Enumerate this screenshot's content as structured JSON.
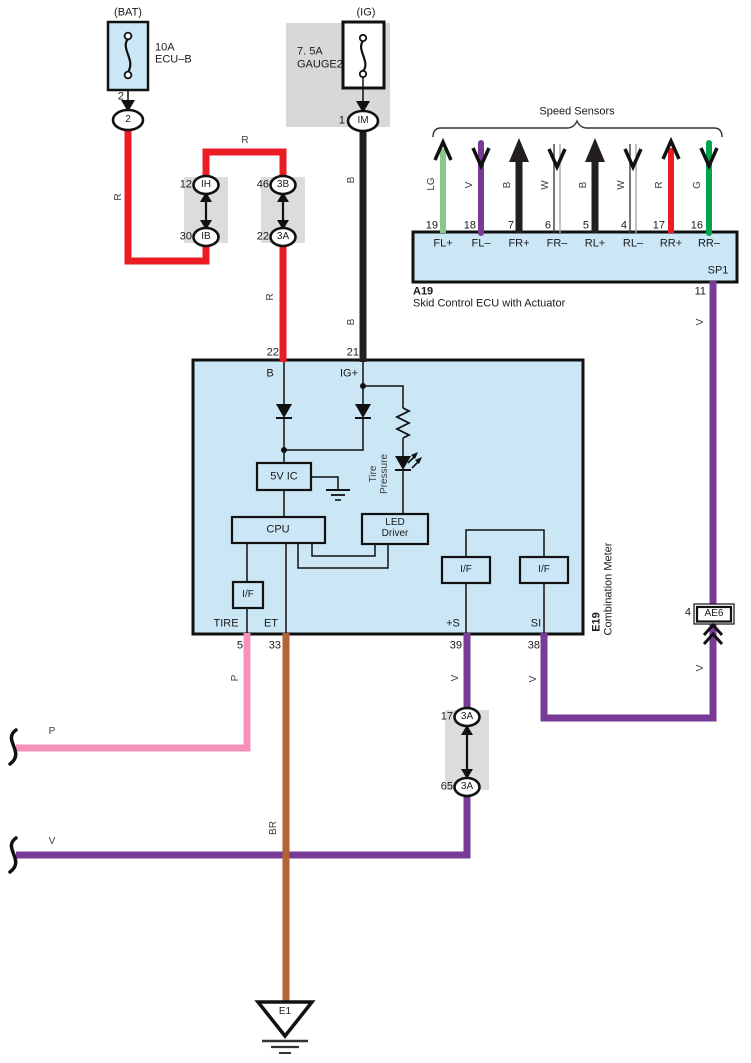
{
  "colors": {
    "box_fill": "#cbe7f6",
    "panel_gray": "#d8d8d8",
    "wire_red": "#ec1c24",
    "wire_black": "#231f20",
    "wire_purple": "#7a3b96",
    "wire_pink": "#f490ba",
    "wire_brown": "#b26235",
    "wire_green": "#00a550",
    "wire_light_green": "#85c98e"
  },
  "bat_circuit": {
    "header": "(BAT)",
    "fuse_rating": "10A",
    "fuse_name": "ECU–B",
    "pin": "2",
    "connector": "2"
  },
  "ig_circuit": {
    "header": "(IG)",
    "fuse_rating": "7. 5A",
    "fuse_name": "GAUGE2",
    "pin": "1",
    "connector": "IM"
  },
  "wires": {
    "r": "R",
    "b": "B",
    "v": "V",
    "p": "P",
    "br": "BR"
  },
  "junction_ih": {
    "top_pin": "12",
    "top_label": "IH",
    "bottom_pin": "30",
    "bottom_label": "IB"
  },
  "junction_3b": {
    "top_pin": "46",
    "top_label": "3B",
    "bottom_pin": "22",
    "bottom_label": "3A"
  },
  "junction_3a": {
    "top_pin": "17",
    "top_label": "3A",
    "bottom_pin": "65",
    "bottom_label": "3A"
  },
  "speed_sensors": {
    "title": "Speed Sensors",
    "channels": [
      {
        "wire_color": "LG",
        "pin": "19",
        "terminal": "FL+"
      },
      {
        "wire_color": "V",
        "pin": "18",
        "terminal": "FL–"
      },
      {
        "wire_color": "B",
        "pin": "7",
        "terminal": "FR+"
      },
      {
        "wire_color": "W",
        "pin": "6",
        "terminal": "FR–"
      },
      {
        "wire_color": "B",
        "pin": "5",
        "terminal": "RL+"
      },
      {
        "wire_color": "W",
        "pin": "4",
        "terminal": "RL–"
      },
      {
        "wire_color": "R",
        "pin": "17",
        "terminal": "RR+"
      },
      {
        "wire_color": "G",
        "pin": "16",
        "terminal": "RR–"
      }
    ]
  },
  "skid_ecu": {
    "id": "A19",
    "name": "Skid Control ECU with Actuator",
    "internal_label": "SP1",
    "output_pin": "11"
  },
  "ae6_connector": {
    "pin": "4",
    "label": "AE6"
  },
  "meter": {
    "id": "E19",
    "name": "Combination Meter",
    "pin_b": "22",
    "terminal_b": "B",
    "pin_ig": "21",
    "terminal_ig": "IG+",
    "pin_tire": "5",
    "terminal_tire": "TIRE",
    "pin_et": "33",
    "terminal_et": "ET",
    "pin_s": "39",
    "terminal_s": "+S",
    "pin_si": "38",
    "terminal_si": "SI",
    "block_5v": "5V IC",
    "block_cpu": "CPU",
    "block_led_1": "LED",
    "block_led_2": "Driver",
    "block_if": "I/F",
    "led_label_1": "Tire",
    "led_label_2": "Pressure"
  },
  "ground": {
    "label": "E1"
  }
}
